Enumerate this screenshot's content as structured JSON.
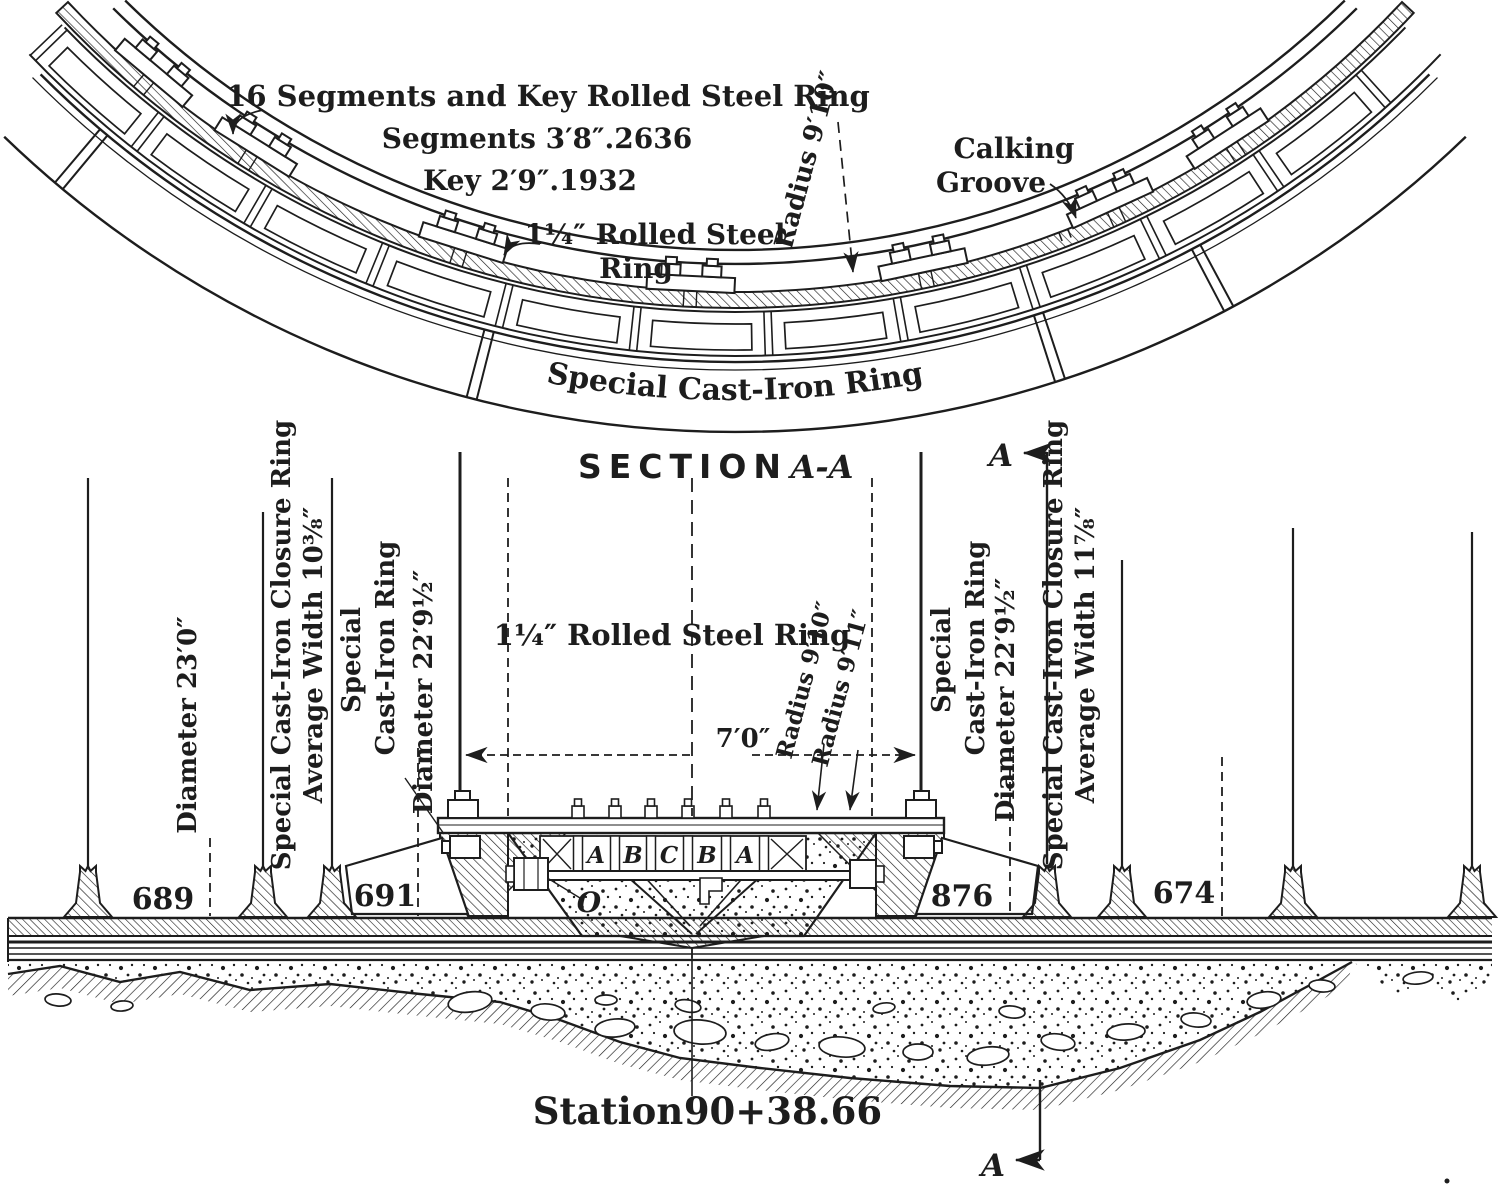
{
  "ink": "#1d1d1d",
  "paper": "#ffffff",
  "plan": {
    "note_line1": "16 Segments and Key Rolled Steel Ring",
    "note_line2": "Segments 3′8″.2636",
    "note_line3": "Key 2′9″.1932",
    "rolled_ring_line1": "1¼″ Rolled Steel",
    "rolled_ring_line2": "Ring",
    "radius_label": "Radius 9′10″",
    "calking_line1": "Calking",
    "calking_line2": "Groove",
    "cast_ring_label": "Special Cast-Iron Ring"
  },
  "section": {
    "title_word": "SECTION",
    "title_cut": "A-A",
    "cut_letter": "A",
    "left": {
      "diameter_outer": "Diameter 23′0″",
      "closure_line1": "Special Cast-Iron Closure Ring",
      "closure_line2": "Average Width 10⅜″",
      "cast_line1": "Special",
      "cast_line2": "Cast-Iron Ring",
      "diameter_inner": "Diameter 22′9½″"
    },
    "center": {
      "rolled_ring": "1¼″ Rolled Steel Ring",
      "width_dim": "7′0″",
      "radius_inner": "Radius 9′10″",
      "radius_outer": "Radius 9′11″",
      "cell_letters": [
        "A",
        "B",
        "C",
        "B",
        "A"
      ],
      "origin_letter": "O"
    },
    "right": {
      "cast_line1": "Special",
      "cast_line2": "Cast-Iron Ring",
      "diameter_inner": "Diameter 22′9½″",
      "closure_line1": "Special Cast-Iron Closure Ring",
      "closure_line2": "Average Width 11⅞″"
    },
    "segment_numbers": [
      "689",
      "691",
      "876",
      "674"
    ],
    "station_label": "Station",
    "station_value": "90+38.66"
  }
}
